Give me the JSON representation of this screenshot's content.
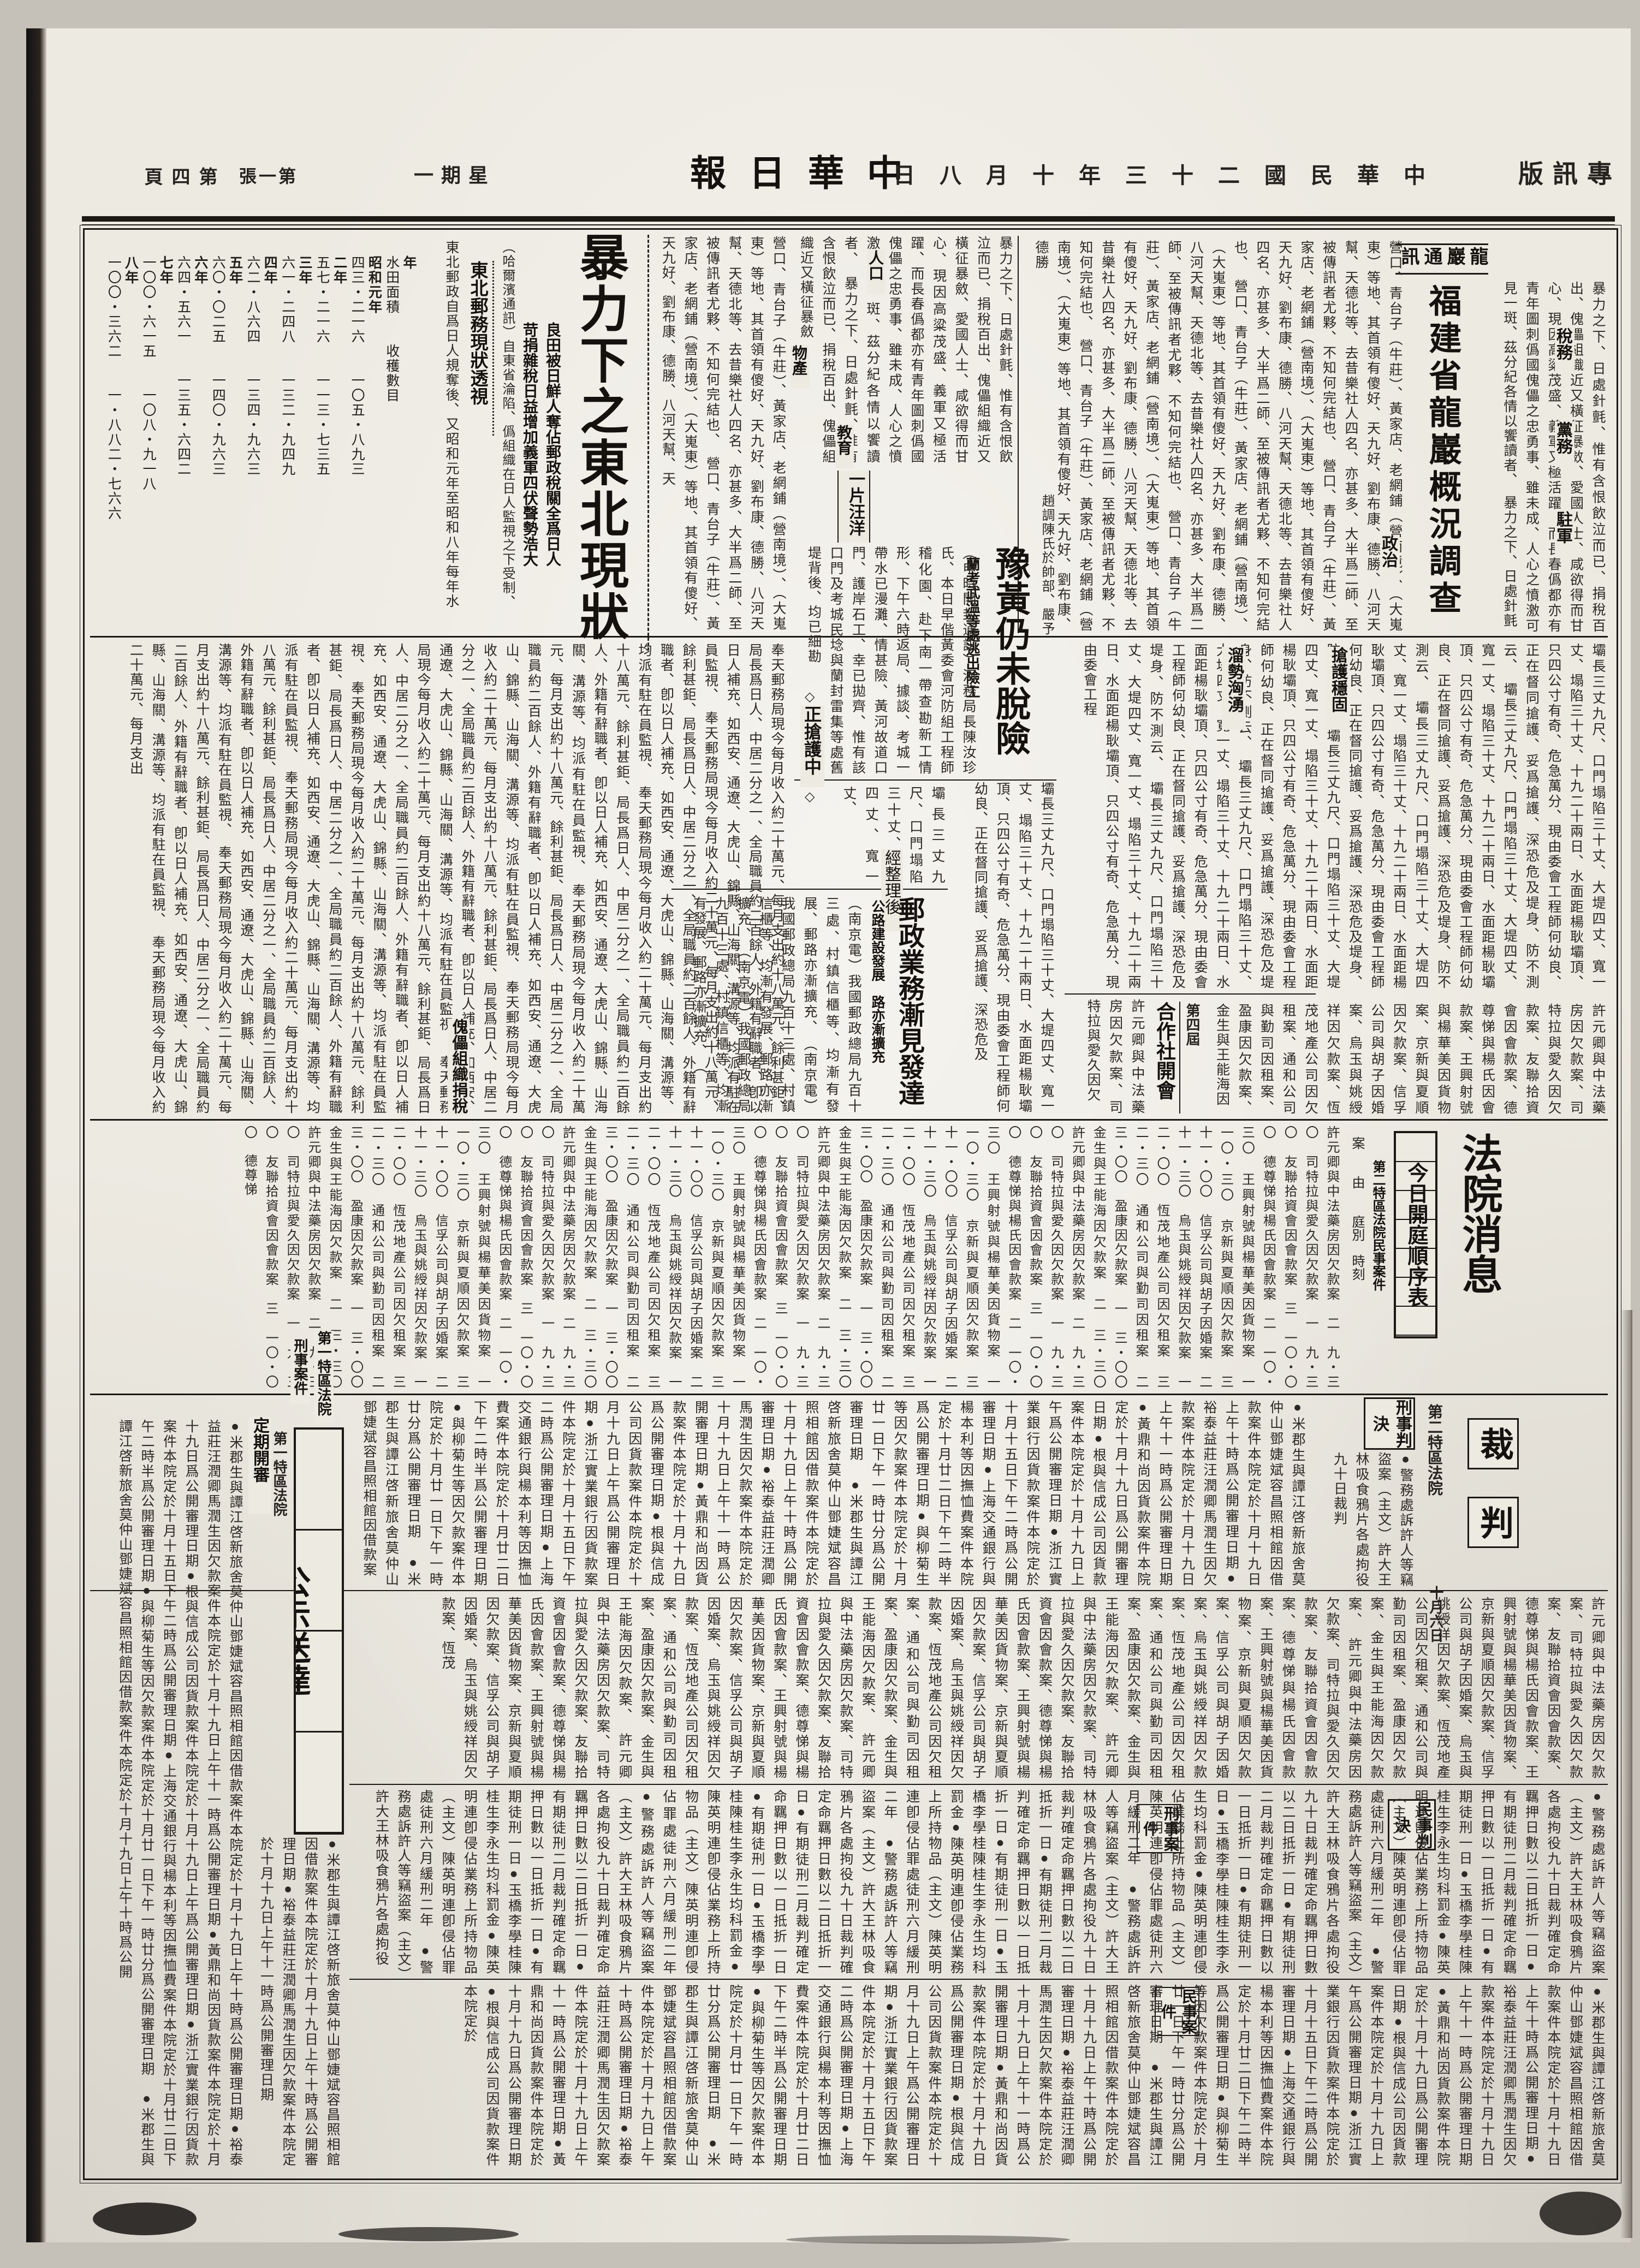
{
  "header": {
    "edition": "專訊版",
    "date": "中華民國二十三年十月八日",
    "weekday": "星期一",
    "masthead": "中華日報",
    "sheet": "第一張",
    "page_no": "第四頁"
  },
  "articles": {
    "fujian": {
      "wire": "龍巖通訊",
      "title": "福建省龍巖概況調查",
      "labels": {
        "l1": "稅務",
        "l2": "黨務",
        "l3": "駐軍",
        "l4": "政治"
      }
    },
    "dongbei": {
      "title": "暴力下之東北現狀",
      "subtitle1": "良田被日鮮人奪佔郵政稅關全爲日人",
      "subtitle2": "苛捐雜稅日益增加義軍四伏聲勢浩大",
      "labels": {
        "l1": "人口",
        "l2": "物產",
        "l3": "教育"
      },
      "postal_head": "東北郵務現狀透視",
      "puppet_head": "傀儡組織捐稅"
    },
    "yuhuang": {
      "title": "豫黃仍未脫險",
      "subtitle": "蘭考武溫等處逃出險工",
      "flood_label": "一片汪洋",
      "rescue_label": "正搶護中",
      "diamond": "◇"
    },
    "postal": {
      "kicker": "經整理後",
      "title": "郵政業務漸見發達",
      "subtitle": "公路建設發展　路亦漸擴充"
    },
    "river": {
      "l1": "搶護穩固",
      "l2": "溜勢洶湧"
    },
    "coop": {
      "pre": "第四屆",
      "title": "合作社開會"
    },
    "court": {
      "title": "法院消息",
      "box": "今日開庭順序表",
      "subtitle": "第二特區法院民事案件",
      "col_headers": "案　　由　　庭別　時刻",
      "section1": "第一特區法院",
      "section2": "刑事案件"
    },
    "caipan": {
      "t1": "裁",
      "t2": "判",
      "court": "第二特區法院",
      "date": "十月六日",
      "box_criminal": "刑事判決",
      "box_civil": "民事判決",
      "label_criminal": "刑事案件",
      "label_civil": "民事案件"
    },
    "gongshi": {
      "title": "公示送達",
      "court": "第一特區法院",
      "label": "定期開審"
    }
  },
  "stats_table": {
    "col_headers": [
      "年",
      "水田面積",
      "收穫數目"
    ],
    "rows": [
      [
        "昭和元年",
        "四三・二一六",
        "一〇五・八九三"
      ],
      [
        "二年",
        "五七・二一六",
        "一一三・七三五"
      ],
      [
        "三年",
        "六一・二四八",
        "一三二・九四九"
      ],
      [
        "四年",
        "六二・八六四",
        "一三四・九六三"
      ],
      [
        "五年",
        "六〇・〇二五",
        "一四〇・九六三"
      ],
      [
        "六年",
        "六四・五六一",
        "一三五・六四二"
      ],
      [
        "七年",
        "一〇〇・六一五",
        "一〇八・九一八"
      ],
      [
        "八年",
        "一〇〇・三六二",
        "一・八八二・七六六"
      ]
    ]
  },
  "excerpts": {
    "dongbei_lead": "（哈爾濱通訊）自東省淪陷、僞組織在日人監視之下受制、其在初強制接收時、已將民衆之郵政易爲日本郵制、近濟原局長仁桂棟、以有污犯嫌疑被扣、故郵局更加監視各局長之行動、",
    "emotion": "暴力之下、日處針氈、惟有含恨飲泣而已、捐稅百出、傀儡組織近又橫征暴斂、愛國人士、咸欲得而甘心、現因高粱茂盛、義軍又極活躍、而長春僞都亦有青年圖刺僞國傀儡之忠勇事、雖未成、人心之憤激可見一斑、茲分紀各情以饗讀者、",
    "postal_stats": "奉天郵務局現今每月收入約二十萬元、每月支出約十八萬元、餘利甚鉅、局長爲日人、中居二分之一、全局職員約二百餘人、外籍有辭職者、卽以日人補充、如西安、通遼、大虎山、錦縣、山海關、溝源等、均派有駐在員監視、",
    "intro": "東北郵政自爲日人規奪後、又昭和元年至昭和八年每年水田及人口增加比較數如左、",
    "towns": "營口、青台子（牛莊）、黃家店、老網鋪（營南境）、（大嵬東）等地、其首領有傻好、天九好、劉布康、德勝、八河天幫、天德北等、去昔樂社人四名、亦甚多、大半爲二師、至被傳訊者尤夥、不知何完結也、",
    "yuhuang_kicker": "趙調陳氏於帥部、嚴予接見、並告以稱樣實爲防匪要圖、",
    "yuhuang_lead": "（申時開封通訊）河務局長陳汝珍氏、本日早偕黃委會河防組工程師稽化園、赴下南一帶查勘新工情形、下午六時返局、據談、考城一帶水已漫灘、情甚險、黃河故道口門、護岸石工、幸已拋齊、惟有該口門及考城民埝與蘭封雷集等處舊堤背後、均已細勘、尚無滲漏情形、當已面飭在工人員、星夜防守、似可無虞、惟自陳留趨西望、",
    "river_numbers": "壩長三丈九尺、口門塌陷三十丈、大堤四丈、寬一丈、塌陷三十丈、十九二十兩日、水面距楊耿壩頂、只四公寸有奇、危急萬分、現由委會工程師何幼良、正在督同搶護、妥爲搶護、深恐危及堤身、防不測云、",
    "postal_lead": "（南京電）我國郵政總局九百十三處、村鎮信櫃等、均漸有發展、郵路亦漸擴充、",
    "gongshi_bullets": "●米郡生與譚江啓新旅舍莫仲山鄧婕斌容昌照相館因借款案件本院定於十月十九日上午十時爲公開審理日期●裕泰益莊汪潤卿馬潤生因欠款案件本院定於十月十九日上午十一時爲公開審理日期●黃鼎和尚因貨款案件本院定於十月十九日爲公開審理日期●根與信成公司因貨款案件本院定於十月十九日上午爲公開審理日期●浙江實業銀行因貨款案件本院定於十月十五日下午二時爲公開審理日期●上海交通銀行與楊本利等因撫恤費案件本院定於十月廿二日下午二時半爲公開審理日期●與柳菊生等因欠款案件本院定於十月廿一日下午一時廿分爲公開審理日期",
    "caipan_bullets": "●警務處訴許人等竊盜案（主文）許大王林吸食鴉片各處拘役九十日裁判確定命羈押日數以二日抵折一日●有期徒刑二月裁判確定命羈押日數以一日抵折一日●有期徒刑一日●玉橋李學桂陳桂生李永生均科罰金●陳英明連卽侵佔業務上所持物品（主文）陳英明連卽侵佔罪處徒刑六月緩刑二年",
    "name_cases": "許元卿與中法藥房因欠款案、司特拉與愛久因欠款案、友聯拾資會因會款案、德尊悌與楊氏因會款案、王興射號與楊華美因貨物案、京新與夏順因欠款案、信孚公司與胡子因婚案、烏玉與姚綬祥因欠款案、恆茂地產公司因欠租案、通和公司與勤司因租案、盈康因欠款案、金生與王能海因欠款案、"
  },
  "docket": [
    "許元卿與中法藥房因欠款案　二　九・三〇",
    "司特拉與愛久因欠款案　一　九・三〇",
    "友聯拾資會因會款案　三　一〇・〇〇",
    "德尊悌與楊氏因會款案　二　一〇・三〇",
    "王興射號與楊華美因貨物案　一　一〇・三〇",
    "京新與夏順因欠款案　三　十一・〇〇",
    "信孚公司與胡子因婚案　二　十一・三〇",
    "烏玉與姚綬祥因欠款案　一　二・〇〇",
    "恆茂地產公司因欠租案　三　二・三〇",
    "通和公司與勤司因租案　二　三・〇〇",
    "盈康因欠款案　一　三・〇〇",
    "金生與王能海因欠款案　二　三・三〇"
  ]
}
